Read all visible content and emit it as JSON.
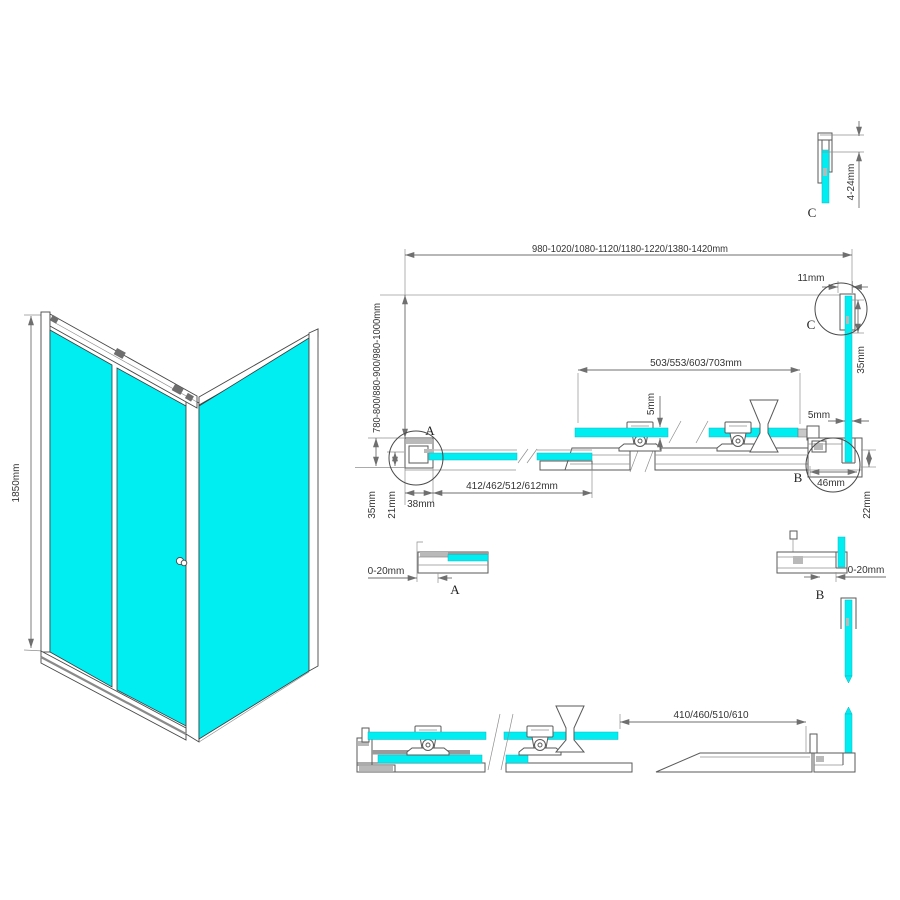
{
  "colors": {
    "glass": "#00eef2",
    "profile_line": "#5a5a5a",
    "dimension_line": "#6f6f6f",
    "text": "#333333"
  },
  "dims": {
    "overall_width": "980-1020/1080-1120/1180-1220/1380-1420mm",
    "top_gap": "11mm",
    "top_adjust": "4-24mm",
    "depth_range": "780-800/880-900/980-1000mm",
    "door_glass_width": "503/553/603/703mm",
    "glass_thickness": "5mm",
    "side_glass_thickness": "5mm",
    "side_profile_height": "35mm",
    "wall_profile_depth": "35mm",
    "glass_to_wall": "21mm",
    "wall_profile_width": "38mm",
    "fixed_glass_width": "412/462/512/612mm",
    "corner_profile_width": "46mm",
    "corner_profile_depth": "22mm",
    "adjust_range_a": "0-20mm",
    "adjust_range_b": "0-20mm",
    "bottom_glass_width": "410/460/510/610",
    "total_height": "1850mm"
  },
  "labels": {
    "detail_a": "A",
    "detail_b": "B",
    "detail_c": "C"
  }
}
